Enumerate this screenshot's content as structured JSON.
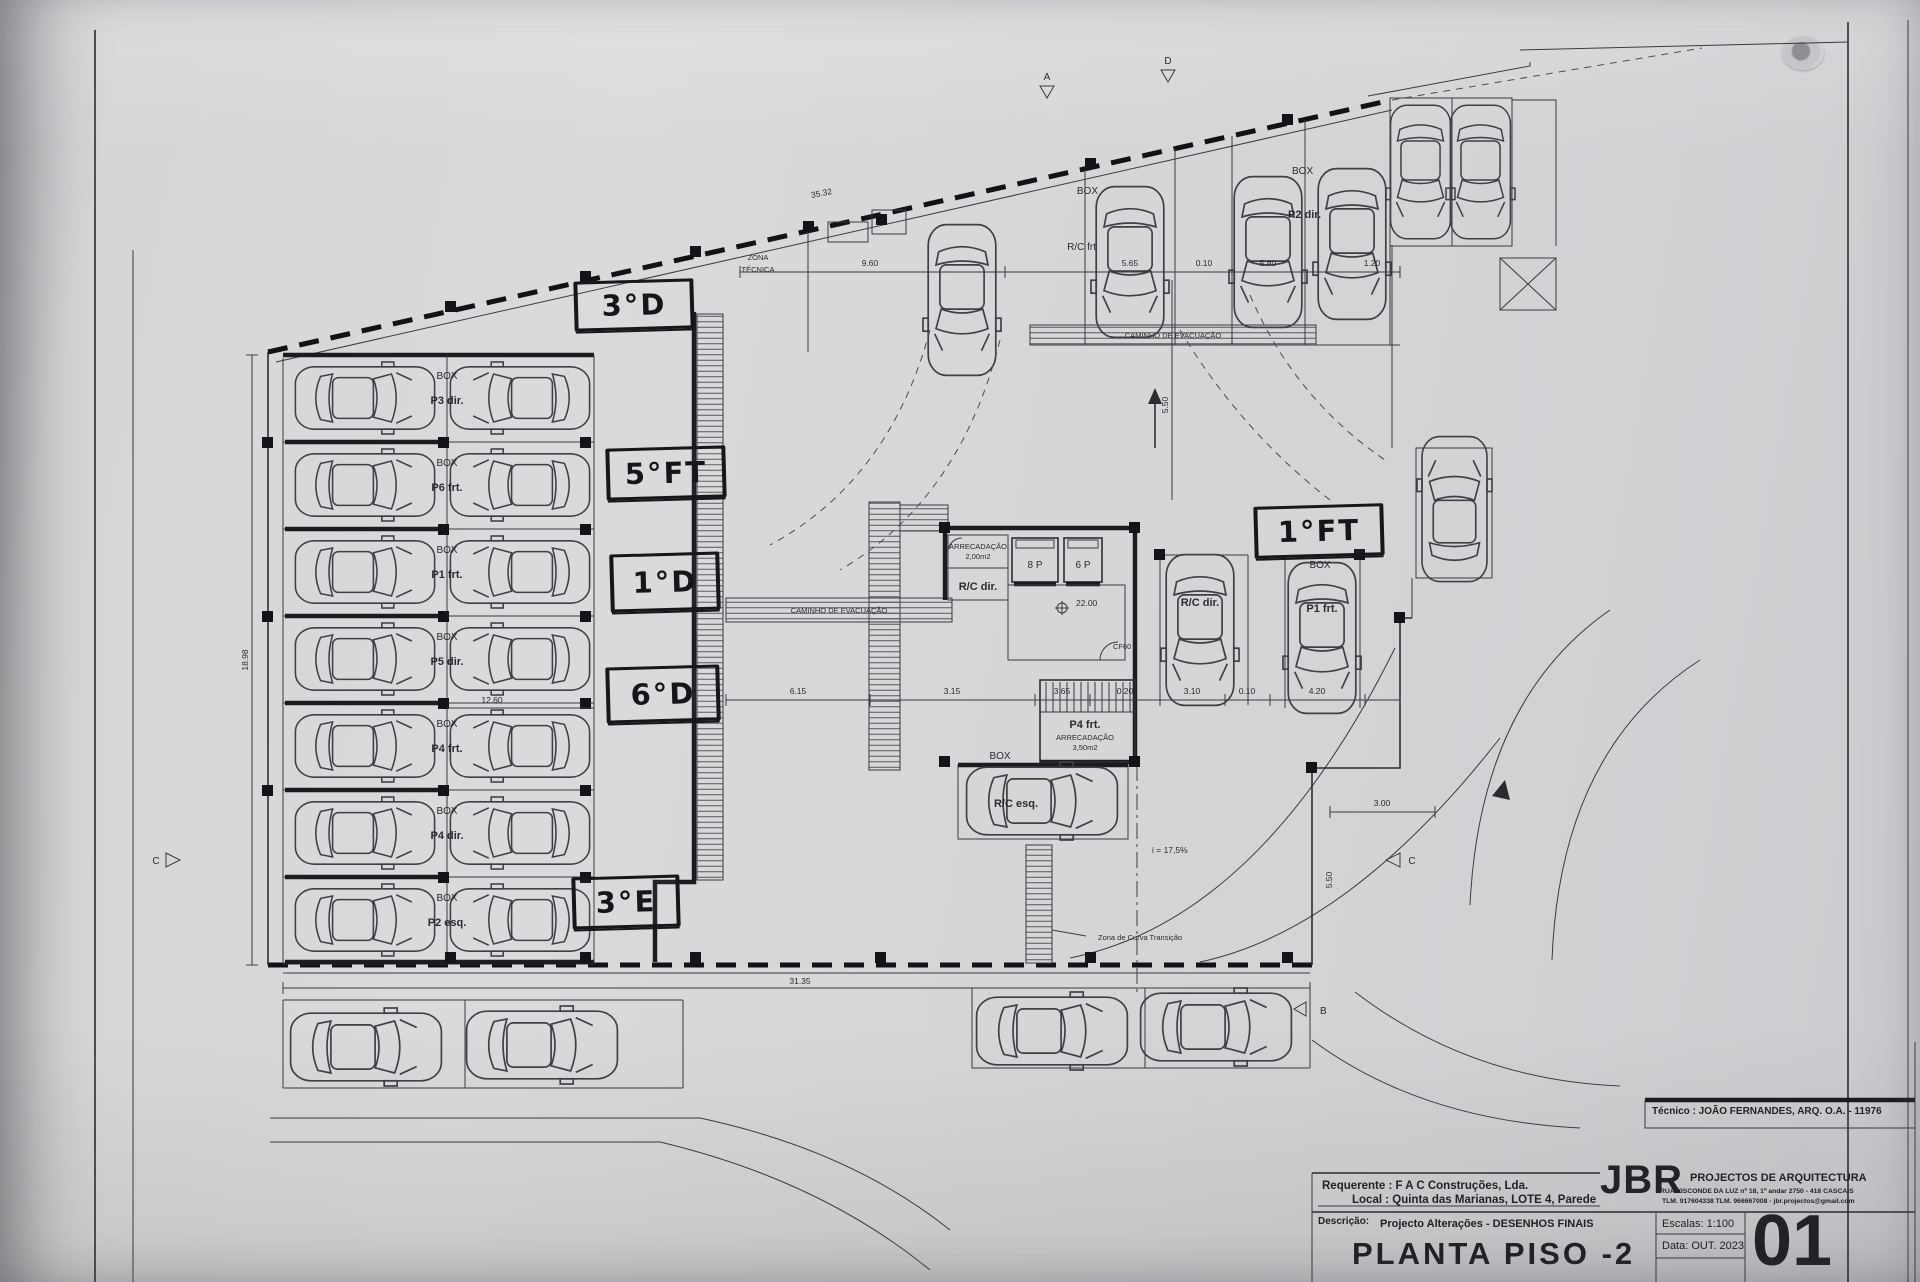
{
  "sheet": {
    "title_block": {
      "tecnico": "Técnico : JOÃO FERNANDES, ARQ.   O.A. - 11976",
      "requerente": "Requerente : F A C  Construções, Lda.",
      "local": "Local : Quinta das Marianas, LOTE 4, Parede",
      "descricao_label": "Descrição:",
      "descricao": "Projecto Alterações - DESENHOS FINAIS",
      "sheet_title": "PLANTA PISO -2",
      "firm_initials": "JBR",
      "firm_name": "PROJECTOS DE ARQUITECTURA",
      "firm_address": "RUA VISCONDE DA LUZ nº 18, 1º andar  2750 - 418  CASCAIS",
      "firm_contacts": "TLM. 917604338  TLM. 966667008 - jbr.projectos@gmail.com",
      "escala": "Escalas:  1:100",
      "data": "Data: OUT.  2023",
      "sheet_number": "01"
    },
    "handwritten": {
      "u3d": "3°D",
      "u5ft": "5°FT",
      "u1d": "1°D",
      "u6d": "6°D",
      "u3e": "3°E",
      "u1ft": "1°FT"
    },
    "zones": {
      "zona_tecnica_1": "ZONA",
      "zona_tecnica_2": "TÉCNICA",
      "caminho": "CAMINHO  DE  EVACUAÇÃO",
      "curva": "Zona  de  Curva  Transição",
      "ramp_slope": "i  =  17,5%"
    },
    "core": {
      "arrecadacao_1a": "ARRECADAÇÃO",
      "arrecadacao_1b": "2,00m2",
      "rc_dir_room": "R/C dir.",
      "lift_left": "8 P",
      "lift_right": "6 P",
      "level": "22.00",
      "door": "CF60",
      "p4_frt": "P4 frt.",
      "arrecadacao_2a": "ARRECADAÇÃO",
      "arrecadacao_2b": "3,50m2"
    },
    "stalls": {
      "top_box_left": "BOX",
      "top_rc_frt": "R/C frt",
      "top_box_right": "BOX",
      "top_p2_dir": "P2 dir.",
      "mid_rc_dir": "R/C dir.",
      "mid_box": "BOX",
      "mid_p1_frt": "P1 frt.",
      "esq_box": "BOX",
      "rc_esq": "R/C esq."
    },
    "left_rows": [
      {
        "box": "BOX",
        "spot": "P3 dir."
      },
      {
        "box": "BOX",
        "spot": "P6 frt."
      },
      {
        "box": "BOX",
        "spot": "P1 frt."
      },
      {
        "box": "BOX",
        "spot": "P5 dir."
      },
      {
        "box": "BOX",
        "spot": "P4 frt."
      },
      {
        "box": "BOX",
        "spot": "P4 dir."
      },
      {
        "box": "BOX",
        "spot": "P2 esq."
      }
    ],
    "dimensions": {
      "top_diag": "35.32",
      "d9_60": "9.60",
      "d5_65": "5.65",
      "d0_10a": "0.10",
      "d5_80": "5.80",
      "d1_20": "1.20",
      "d5_50a": "5.50",
      "d18_98": "18.98",
      "d12_60": "12.60",
      "d31_35": "31.35",
      "d6_15": "6.15",
      "d3_15": "3.15",
      "d3_65": "3.65",
      "d0_20": "0.20",
      "d3_10": "3.10",
      "d0_10b": "0.10",
      "d4_20": "4.20",
      "d3_00": "3.00",
      "d5_50b": "5.50"
    },
    "markers": {
      "m_a": "A",
      "m_d": "D",
      "m_c_left": "C",
      "m_c_right": "C",
      "m_b": "B"
    }
  }
}
